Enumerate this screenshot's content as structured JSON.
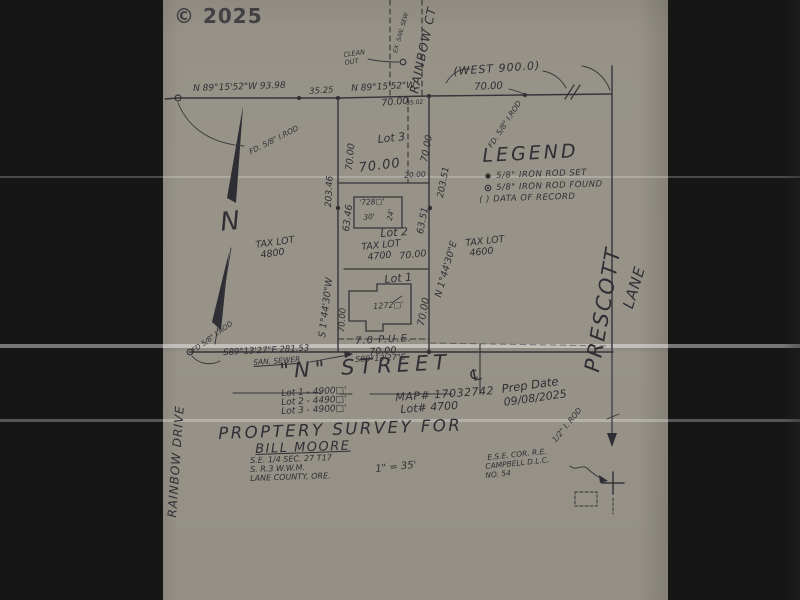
{
  "watermark": "© 2025",
  "colors": {
    "paper": "#d6d4cf",
    "ink": "#2f2e34",
    "background": "#161616"
  },
  "top": {
    "clean_out": "CLEAN OUT",
    "sewer_note": "EX. SAN. SEW.",
    "rainbow_ct": "RAINBOW CT",
    "west_900": "(WEST 900.0)",
    "bearing_nw_1": "N 89°15'52\"W  93.98",
    "dist_3525": "35.25",
    "bearing_nw_2": "N 89°15'52\"W",
    "dist_70_a": "70.00",
    "dist_3502": "35.02",
    "dist_70_b": "70.00",
    "fd_rod_left": "FD. 5/8\" I.ROD",
    "fd_rod_right": "FD. 5/8\" I.ROD"
  },
  "legend": {
    "title": "LEGEND",
    "item_set": "5/8\" IRON ROD SET",
    "item_found": "5/8\" IRON ROD FOUND",
    "item_record": "(  )  DATA OF RECORD"
  },
  "north": {
    "label": "N"
  },
  "lots": {
    "lot3": "Lot 3",
    "lot2": "Lot 2",
    "lot1": "Lot 1",
    "tax4800a": "TAX LOT",
    "tax4800b": "4800",
    "tax4700a": "TAX LOT",
    "tax4700b": "4700",
    "tax4600a": "TAX LOT",
    "tax4600b": "4600",
    "bldg728": "'728□'",
    "bldg728_w": "30'",
    "bldg728_d": "24'",
    "bldg1272": "1272□'"
  },
  "dims": {
    "d70_l3_left": "70.00",
    "d70_l3_right": "70.00",
    "d203_46": "203.46",
    "d203_51": "203.51",
    "brg_w": "S 1°44'30\"W",
    "brg_e": "N 1°44'30\"E",
    "d70_mid": "70.00",
    "d20": "20.00",
    "d63_46": "63.46",
    "d63_51": "63.51",
    "d70_lot2": "70.00",
    "d70_l1_left": "70.00",
    "d70_l1_right": "70.00",
    "pue": "7.0 P.U.E.",
    "d70_pue": "70.00",
    "brg_se": "S89°13'27\"E",
    "brg_se_long": "S89°13'27\"E  281.53",
    "san_sewer": "SAN. SEWER",
    "fd_rod_bl": "FD 5/8\" I.ROD",
    "rod_half": "1/2\" I. ROD"
  },
  "streets": {
    "n_street": "\"N\"  STREET",
    "prescott": "PRESCOTT",
    "lane": "LANE",
    "rainbow_drive": "RAINBOW DRIVE",
    "centerline_symbol": "℄"
  },
  "titleblock": {
    "area1": "Lot 1 - 4900□'",
    "area2": "Lot 2 - 4490□'",
    "area3": "Lot 3 - 4900□'",
    "map_num": "MAP# 17032742",
    "lot_num": "Lot# 4700",
    "prep_label": "Prep Date",
    "prep_value": "09/08/2025",
    "title": "PROPTERY SURVEY FOR",
    "client": "BILL MOORE",
    "loc1": "S.E. 1/4 SEC. 27 T17",
    "loc2": "S. R.3 W.W.M.",
    "loc3": "LANE COUNTY, ORE.",
    "scale": "1\" = 35'",
    "cor1": "E.S.E. COR. R.E.",
    "cor2": "CAMPBELL D.L.C.",
    "cor3": "NO. 54"
  }
}
